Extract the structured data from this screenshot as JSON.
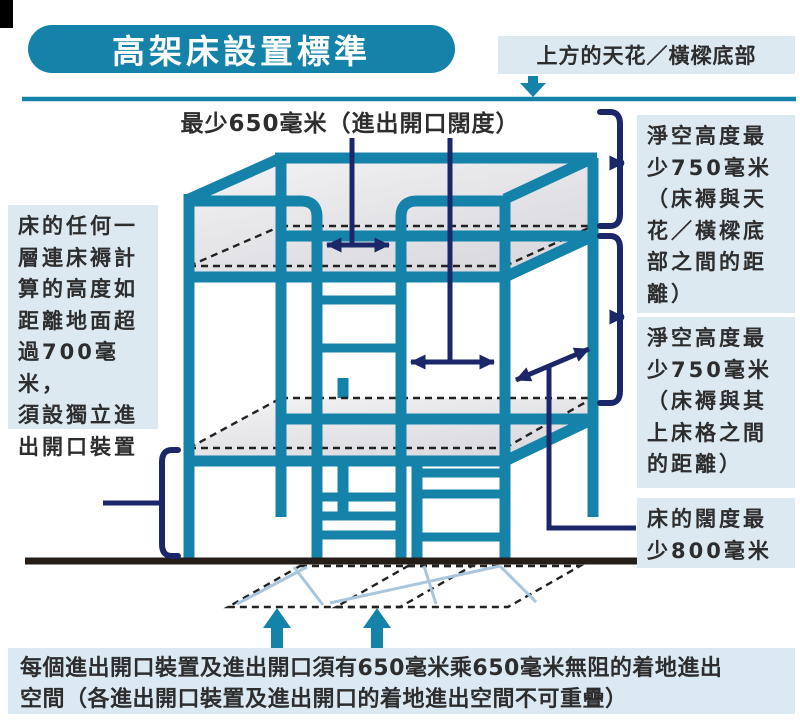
{
  "title": "高架床設置標準",
  "ceiling_label": "上方的天花／橫樑底部",
  "top_measure_label": "最少650毫米（進出開口闊度）",
  "left_note": "床的任何一\n層連床褥計\n算的高度如\n距離地面超\n過700毫米，\n須設獨立進\n出開口裝置",
  "right_notes": {
    "clearance_ceiling": "淨空高度最\n少750毫米\n（床褥與天\n花／橫樑底\n部之間的距\n離）",
    "clearance_upper": "淨空高度最\n少750毫米\n（床褥與其\n上床格之間\n的距離）",
    "bed_width": "床的闊度最\n少800毫米"
  },
  "bottom_note": "每個進出開口裝置及進出開口須有650毫米乘650毫米無阻的着地進出\n空間（各進出開口裝置及進出開口的着地進出空間不可重疊）",
  "colors": {
    "teal": "#1583a9",
    "navy": "#1b2768",
    "label_bg": "#dde9f0",
    "bottom_bg": "#dbeaf2",
    "text": "#2d2d2d",
    "floor": "#241d18",
    "floor_guide": "#a9c6dc",
    "mattress_light": "#f4f4f6",
    "mattress_dark": "#d8d8dd"
  }
}
